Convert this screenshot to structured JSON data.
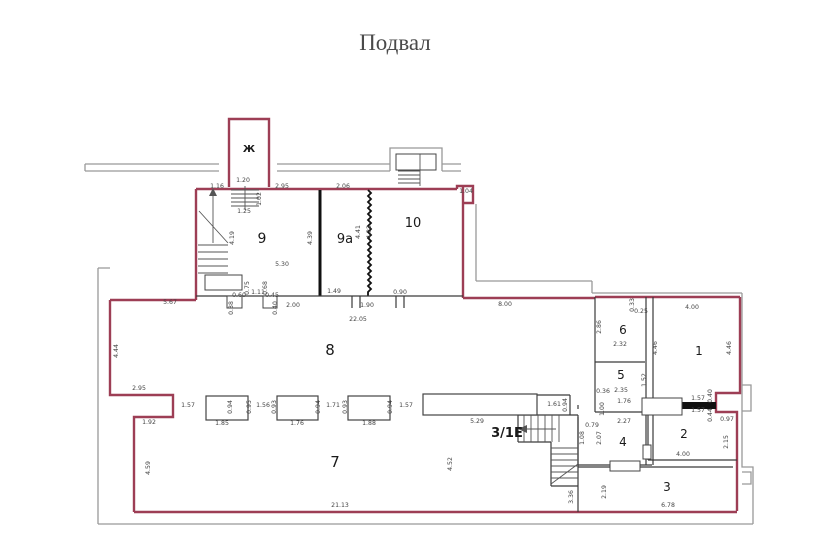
{
  "title": "Подвал",
  "colors": {
    "outer_wall": "#999999",
    "unit_wall": "#9d3e55",
    "inner_wall": "#3a3a3a",
    "accent_label": "#bf2065",
    "dimension_text": "#444444",
    "room_text": "#1a1a1a",
    "title_text": "#4a4a4a"
  },
  "special_labels": [
    {
      "name": "stairwell-letter",
      "text": "Ж",
      "x": 249,
      "y": 152,
      "size": 10,
      "bold": true,
      "color": "#1a1a1a"
    },
    {
      "name": "unit-label-3-1e",
      "text": "3/1Е",
      "x": 507,
      "y": 437,
      "size": 13,
      "bold": true,
      "color": "#bf2065"
    }
  ],
  "rooms": [
    {
      "name": "room-9",
      "text": "9",
      "x": 262,
      "y": 243,
      "size": 14
    },
    {
      "name": "room-9a",
      "text": "9а",
      "x": 345,
      "y": 243,
      "size": 13
    },
    {
      "name": "room-10",
      "text": "10",
      "x": 413,
      "y": 227,
      "size": 13
    },
    {
      "name": "room-8",
      "text": "8",
      "x": 330,
      "y": 355,
      "size": 15
    },
    {
      "name": "room-7",
      "text": "7",
      "x": 335,
      "y": 467,
      "size": 15
    },
    {
      "name": "room-6",
      "text": "6",
      "x": 623,
      "y": 334,
      "size": 12
    },
    {
      "name": "room-5",
      "text": "5",
      "x": 621,
      "y": 379,
      "size": 12
    },
    {
      "name": "room-4",
      "text": "4",
      "x": 623,
      "y": 446,
      "size": 12
    },
    {
      "name": "room-1",
      "text": "1",
      "x": 699,
      "y": 355,
      "size": 12
    },
    {
      "name": "room-2",
      "text": "2",
      "x": 684,
      "y": 438,
      "size": 12
    },
    {
      "name": "room-3",
      "text": "3",
      "x": 667,
      "y": 491,
      "size": 12
    }
  ],
  "dimensions": [
    {
      "t": "1.16",
      "x": 217,
      "y": 188
    },
    {
      "t": "1.20",
      "x": 243,
      "y": 182
    },
    {
      "t": "2.95",
      "x": 282,
      "y": 188
    },
    {
      "t": "2.06",
      "x": 343,
      "y": 188
    },
    {
      "t": "1.04",
      "x": 466,
      "y": 193
    },
    {
      "t": "1.25",
      "x": 244,
      "y": 213
    },
    {
      "t": "1.02",
      "x": 261,
      "y": 199,
      "r": true
    },
    {
      "t": "4.19",
      "x": 234,
      "y": 238,
      "r": true
    },
    {
      "t": "4.39",
      "x": 312,
      "y": 238,
      "r": true
    },
    {
      "t": "4.41",
      "x": 360,
      "y": 232,
      "r": true
    },
    {
      "t": "4.32",
      "x": 371,
      "y": 232,
      "r": true
    },
    {
      "t": "5.30",
      "x": 282,
      "y": 266
    },
    {
      "t": "0.75",
      "x": 249,
      "y": 288,
      "r": true
    },
    {
      "t": "1.11",
      "x": 258,
      "y": 294
    },
    {
      "t": "0.68",
      "x": 267,
      "y": 288,
      "r": true
    },
    {
      "t": "0.60",
      "x": 239,
      "y": 297
    },
    {
      "t": "0.38",
      "x": 233,
      "y": 308,
      "r": true
    },
    {
      "t": "0.45",
      "x": 272,
      "y": 297
    },
    {
      "t": "0.40",
      "x": 277,
      "y": 308,
      "r": true
    },
    {
      "t": "2.00",
      "x": 293,
      "y": 307
    },
    {
      "t": "1.49",
      "x": 334,
      "y": 293
    },
    {
      "t": "1.90",
      "x": 367,
      "y": 307
    },
    {
      "t": "0.90",
      "x": 400,
      "y": 294
    },
    {
      "t": "8.00",
      "x": 505,
      "y": 306
    },
    {
      "t": "5.67",
      "x": 170,
      "y": 304
    },
    {
      "t": "22.05",
      "x": 358,
      "y": 321
    },
    {
      "t": "4.44",
      "x": 118,
      "y": 351,
      "r": true
    },
    {
      "t": "2.95",
      "x": 139,
      "y": 390
    },
    {
      "t": "1.92",
      "x": 149,
      "y": 424
    },
    {
      "t": "4.59",
      "x": 150,
      "y": 468,
      "r": true
    },
    {
      "t": "21.13",
      "x": 340,
      "y": 507
    },
    {
      "t": "1.57",
      "x": 188,
      "y": 407
    },
    {
      "t": "0.94",
      "x": 232,
      "y": 407,
      "r": true
    },
    {
      "t": "1.85",
      "x": 222,
      "y": 425
    },
    {
      "t": "0.95",
      "x": 251,
      "y": 407,
      "r": true
    },
    {
      "t": "1.56",
      "x": 263,
      "y": 407
    },
    {
      "t": "0.93",
      "x": 276,
      "y": 407,
      "r": true
    },
    {
      "t": "1.76",
      "x": 297,
      "y": 425
    },
    {
      "t": "0.94",
      "x": 320,
      "y": 407,
      "r": true
    },
    {
      "t": "1.71",
      "x": 333,
      "y": 407
    },
    {
      "t": "0.93",
      "x": 347,
      "y": 407,
      "r": true
    },
    {
      "t": "1.88",
      "x": 369,
      "y": 425
    },
    {
      "t": "0.94",
      "x": 392,
      "y": 407,
      "r": true
    },
    {
      "t": "1.57",
      "x": 406,
      "y": 407
    },
    {
      "t": "5.29",
      "x": 477,
      "y": 423
    },
    {
      "t": "4.52",
      "x": 452,
      "y": 464,
      "r": true
    },
    {
      "t": "1.61",
      "x": 554,
      "y": 406
    },
    {
      "t": "0.94",
      "x": 567,
      "y": 405,
      "r": true
    },
    {
      "t": "3.36",
      "x": 573,
      "y": 497,
      "r": true
    },
    {
      "t": "2.19",
      "x": 606,
      "y": 492,
      "r": true
    },
    {
      "t": "6.78",
      "x": 668,
      "y": 507
    },
    {
      "t": "4.00",
      "x": 683,
      "y": 456
    },
    {
      "t": "2.15",
      "x": 728,
      "y": 442,
      "r": true
    },
    {
      "t": "0.97",
      "x": 727,
      "y": 421
    },
    {
      "t": "1.57",
      "x": 698,
      "y": 400
    },
    {
      "t": "1.57",
      "x": 698,
      "y": 412
    },
    {
      "t": "0.40",
      "x": 712,
      "y": 396,
      "r": true
    },
    {
      "t": "0.44",
      "x": 712,
      "y": 415,
      "r": true
    },
    {
      "t": "0.36",
      "x": 603,
      "y": 393
    },
    {
      "t": "2.35",
      "x": 621,
      "y": 392
    },
    {
      "t": "1.76",
      "x": 624,
      "y": 403
    },
    {
      "t": "1.00",
      "x": 604,
      "y": 409,
      "r": true
    },
    {
      "t": "1.52",
      "x": 646,
      "y": 380,
      "r": true
    },
    {
      "t": "2.27",
      "x": 624,
      "y": 423
    },
    {
      "t": "2.07",
      "x": 601,
      "y": 438,
      "r": true
    },
    {
      "t": "0.79",
      "x": 592,
      "y": 427
    },
    {
      "t": "1.08",
      "x": 584,
      "y": 438,
      "r": true
    },
    {
      "t": "2.86",
      "x": 601,
      "y": 327,
      "r": true
    },
    {
      "t": "0.33",
      "x": 634,
      "y": 305,
      "r": true
    },
    {
      "t": "0.25",
      "x": 641,
      "y": 313
    },
    {
      "t": "2.32",
      "x": 620,
      "y": 346
    },
    {
      "t": "4.00",
      "x": 692,
      "y": 309
    },
    {
      "t": "4.46",
      "x": 657,
      "y": 348,
      "r": true
    },
    {
      "t": "4.46",
      "x": 731,
      "y": 348,
      "r": true
    }
  ]
}
